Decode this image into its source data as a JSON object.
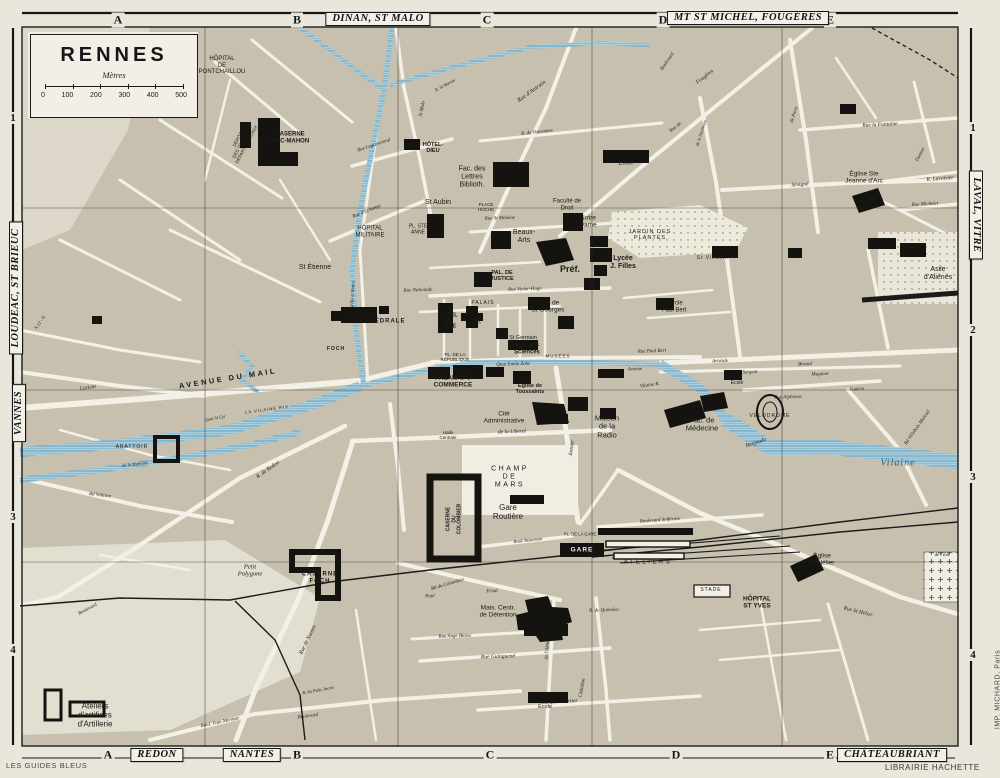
{
  "title_box": {
    "title": "RENNES",
    "unit_label": "Mètres",
    "scale_ticks": [
      "0",
      "100",
      "200",
      "300",
      "400",
      "500"
    ]
  },
  "frame": {
    "top_letters": [
      {
        "t": "A",
        "x": 118
      },
      {
        "t": "B",
        "x": 297
      },
      {
        "t": "C",
        "x": 487
      },
      {
        "t": "D",
        "x": 663
      },
      {
        "t": "E",
        "x": 830
      }
    ],
    "bottom_letters": [
      {
        "t": "A",
        "x": 108
      },
      {
        "t": "B",
        "x": 297
      },
      {
        "t": "C",
        "x": 490
      },
      {
        "t": "D",
        "x": 676
      },
      {
        "t": "E",
        "x": 830
      }
    ],
    "left_numbers": [
      {
        "t": "1",
        "y": 118
      },
      {
        "t": "3",
        "y": 517
      },
      {
        "t": "4",
        "y": 650
      }
    ],
    "right_numbers": [
      {
        "t": "1",
        "y": 128
      },
      {
        "t": "2",
        "y": 330
      },
      {
        "t": "3",
        "y": 477
      },
      {
        "t": "4",
        "y": 655
      }
    ],
    "plates": [
      {
        "t": "DINAN, ST MALO",
        "x": 378,
        "y": 19,
        "r": 0
      },
      {
        "t": "MT ST MICHEL, FOUGÈRES",
        "x": 748,
        "y": 18,
        "r": 0
      },
      {
        "t": "REDON",
        "x": 157,
        "y": 755,
        "r": 0
      },
      {
        "t": "NANTES",
        "x": 252,
        "y": 755,
        "r": 0
      },
      {
        "t": "CHÂTEAUBRIANT",
        "x": 892,
        "y": 755,
        "r": 0
      },
      {
        "t": "LOUDEAC, ST BRIEUC",
        "x": 16,
        "y": 288,
        "r": -90
      },
      {
        "t": "VANNES",
        "x": 19,
        "y": 413,
        "r": -90
      },
      {
        "t": "LAVAL, VITRÉ",
        "x": 976,
        "y": 215,
        "r": 90
      }
    ]
  },
  "credits": {
    "publisher_left": "LES GUIDES BLEUS",
    "publisher_right": "LIBRAIRIE HACHETTE",
    "printer": "IMP. MICHARD, Paris"
  },
  "map_labels": [
    {
      "t": "HÔPITAL\nDE\nPONTCHAILLOU",
      "x": 222,
      "y": 66,
      "s": 6
    },
    {
      "t": "CASERNE\nMAC-MAHON",
      "x": 290,
      "y": 138,
      "s": 6,
      "c": "b"
    },
    {
      "t": "DÉPÔT\nDES TRAMWAYS\nDÉPARTEMENTAUX",
      "x": 242,
      "y": 142,
      "s": 4.5,
      "r": -62
    },
    {
      "t": "HÔTEL-\nDIEU",
      "x": 433,
      "y": 148,
      "s": 5.5,
      "c": "b"
    },
    {
      "t": "Fac. des\nLettres\nBiblioth.",
      "x": 472,
      "y": 177,
      "s": 7
    },
    {
      "t": "St Aubin",
      "x": 438,
      "y": 203,
      "s": 7
    },
    {
      "t": "PL. STE\nANNE",
      "x": 418,
      "y": 230,
      "s": 5
    },
    {
      "t": "PLACE\nHOCHE",
      "x": 486,
      "y": 207,
      "s": 4.5
    },
    {
      "t": "HÔPITAL\nMILITAIRE",
      "x": 370,
      "y": 232,
      "s": 6
    },
    {
      "t": "St Étienne",
      "x": 315,
      "y": 268,
      "s": 7
    },
    {
      "t": "CATHÉDRALE",
      "x": 380,
      "y": 322,
      "s": 6,
      "c": "b sp"
    },
    {
      "t": "HÔTEL\nDE\nVILLE",
      "x": 449,
      "y": 322,
      "s": 5,
      "c": "b"
    },
    {
      "t": "Th.",
      "x": 477,
      "y": 323,
      "s": 6
    },
    {
      "t": "PALAIS",
      "x": 483,
      "y": 304,
      "s": 5,
      "c": "sp"
    },
    {
      "t": "PAL. DE\nJUSTICE",
      "x": 502,
      "y": 276,
      "s": 5.5,
      "c": "b"
    },
    {
      "t": "Beaux-\nArts",
      "x": 524,
      "y": 237,
      "s": 7
    },
    {
      "t": "Faculté de\nDroit",
      "x": 567,
      "y": 205,
      "s": 6
    },
    {
      "t": "Notre\nDame",
      "x": 588,
      "y": 222,
      "s": 6.5
    },
    {
      "t": "École",
      "x": 626,
      "y": 164,
      "s": 6
    },
    {
      "t": "JARDIN DES\nPLANTES",
      "x": 650,
      "y": 235,
      "s": 5.5,
      "c": "sp"
    },
    {
      "t": "Lycée\nJ. Filles",
      "x": 623,
      "y": 263,
      "s": 7,
      "c": "b"
    },
    {
      "t": "Préf.",
      "x": 570,
      "y": 269,
      "s": 9,
      "c": "b"
    },
    {
      "t": "Abb. de\nSt Georges",
      "x": 548,
      "y": 307,
      "s": 6.5
    },
    {
      "t": "St Germain",
      "x": 523,
      "y": 338,
      "s": 5.5
    },
    {
      "t": "Fac. des\nSciences",
      "x": 527,
      "y": 349,
      "s": 6,
      "c": "b"
    },
    {
      "t": "MUSÉES",
      "x": 558,
      "y": 356,
      "s": 4.5,
      "c": "sp"
    },
    {
      "t": "Cercle\nPaul Bert",
      "x": 674,
      "y": 307,
      "s": 6
    },
    {
      "t": "St Vincent",
      "x": 713,
      "y": 259,
      "s": 5,
      "c": "sp"
    },
    {
      "t": "PL. DE LA\nRÉPUBLIQUE",
      "x": 455,
      "y": 357,
      "s": 4.5
    },
    {
      "t": "PALAIS D U\nCOMMERCE",
      "x": 453,
      "y": 382,
      "s": 6.5,
      "c": "b"
    },
    {
      "t": "Église de\nToussaints",
      "x": 530,
      "y": 389,
      "s": 5.5,
      "c": "b"
    },
    {
      "t": "Cité\nAdministrative",
      "x": 504,
      "y": 418,
      "s": 6.5
    },
    {
      "t": "Halle\nCentrale",
      "x": 448,
      "y": 435,
      "s": 4.5
    },
    {
      "t": "Maison\nde la\nRadio",
      "x": 607,
      "y": 427,
      "s": 7.5
    },
    {
      "t": "Fac. de\nMédecine",
      "x": 702,
      "y": 425,
      "s": 7.5
    },
    {
      "t": "VÉLODROME",
      "x": 770,
      "y": 417,
      "s": 5,
      "c": "sp"
    },
    {
      "t": "École",
      "x": 737,
      "y": 384,
      "s": 5
    },
    {
      "t": "ABATTOIR",
      "x": 132,
      "y": 448,
      "s": 5,
      "c": "sp"
    },
    {
      "t": "CHAMP\nDE\nMARS",
      "x": 510,
      "y": 477,
      "s": 7,
      "c": "sp2"
    },
    {
      "t": "Gare\nRoutière",
      "x": 508,
      "y": 513,
      "s": 8
    },
    {
      "t": "CASERNE\nDU\nCOLOMBIER",
      "x": 455,
      "y": 519,
      "s": 5,
      "r": -90,
      "c": "b"
    },
    {
      "t": "PL. DE LA GARE",
      "x": 580,
      "y": 535,
      "s": 4.2
    },
    {
      "t": "GARE",
      "x": 582,
      "y": 550,
      "s": 6.5,
      "c": "b w sp"
    },
    {
      "t": "ATELIERS",
      "x": 648,
      "y": 563,
      "s": 6,
      "c": "sp2"
    },
    {
      "t": "STADE",
      "x": 711,
      "y": 591,
      "s": 5,
      "c": "sp"
    },
    {
      "t": "HÔPITAL\nST YVES",
      "x": 757,
      "y": 603,
      "s": 6.5,
      "c": "b"
    },
    {
      "t": "Église\nSt Hélier",
      "x": 822,
      "y": 560,
      "s": 6.5
    },
    {
      "t": "Petit\nPolygone",
      "x": 250,
      "y": 571,
      "s": 6.5,
      "c": "i"
    },
    {
      "t": "CASERNE\nFOCH",
      "x": 320,
      "y": 578,
      "s": 6,
      "c": "b sp"
    },
    {
      "t": "Mais. Centr.\nde Détention",
      "x": 498,
      "y": 612,
      "s": 6.5
    },
    {
      "t": "École",
      "x": 545,
      "y": 707,
      "s": 5.5
    },
    {
      "t": "Ateliers\nd'artifices\nd'Artillerie",
      "x": 95,
      "y": 716,
      "s": 8
    },
    {
      "t": "Asile\nd'Aliénés",
      "x": 938,
      "y": 274,
      "s": 7
    },
    {
      "t": "Église Ste\nJeanne d'Arc",
      "x": 864,
      "y": 178,
      "s": 6.5
    },
    {
      "t": "de l'Est",
      "x": 942,
      "y": 556,
      "s": 5,
      "c": "i"
    },
    {
      "t": "Vilaine",
      "x": 898,
      "y": 463,
      "s": 10,
      "c": "i blue sp"
    },
    {
      "t": "Vilaine R.",
      "x": 650,
      "y": 386,
      "s": 5,
      "r": -8,
      "c": "i"
    },
    {
      "t": "Baignade",
      "x": 756,
      "y": 443,
      "s": 5.5,
      "r": -18,
      "c": "i"
    },
    {
      "t": "LA VILAINE RIV.",
      "x": 268,
      "y": 410,
      "s": 4.2,
      "r": -8,
      "c": "sp"
    },
    {
      "t": "AVENUE DU MAIL",
      "x": 228,
      "y": 379,
      "s": 7.5,
      "r": -9,
      "c": "b sp2"
    },
    {
      "t": "Quai Emile Zola",
      "x": 513,
      "y": 365,
      "s": 5,
      "r": -2,
      "c": "i"
    },
    {
      "t": "Rue Nationale",
      "x": 418,
      "y": 291,
      "s": 5,
      "r": -2,
      "c": "i"
    },
    {
      "t": "Rue Victor-Hugo",
      "x": 525,
      "y": 290,
      "s": 5,
      "r": -2,
      "c": "i"
    },
    {
      "t": "Rue St Melaine",
      "x": 500,
      "y": 219,
      "s": 5,
      "r": -2,
      "c": "i"
    },
    {
      "t": "Rue d'Antrain",
      "x": 532,
      "y": 92,
      "s": 6,
      "r": -36,
      "c": "i"
    },
    {
      "t": "R. de Vincennes",
      "x": 537,
      "y": 133,
      "s": 5,
      "r": -6,
      "c": "i"
    },
    {
      "t": "Rue de",
      "x": 676,
      "y": 128,
      "s": 5,
      "r": -38,
      "c": "i"
    },
    {
      "t": "Fougères",
      "x": 705,
      "y": 77,
      "s": 5.5,
      "r": -38,
      "c": "i"
    },
    {
      "t": "Boulevard",
      "x": 668,
      "y": 62,
      "s": 5,
      "r": -55,
      "c": "i"
    },
    {
      "t": "de la Duchesse",
      "x": 701,
      "y": 133,
      "s": 4.5,
      "r": -72,
      "c": "i"
    },
    {
      "t": "R. St Martin",
      "x": 445,
      "y": 85,
      "s": 4.5,
      "r": -28,
      "c": "i"
    },
    {
      "t": "St Malo",
      "x": 423,
      "y": 109,
      "s": 5,
      "r": -78,
      "c": "i"
    },
    {
      "t": "Rue Legraverend",
      "x": 374,
      "y": 146,
      "s": 5,
      "r": -18,
      "c": "i"
    },
    {
      "t": "Rue d'Echange",
      "x": 367,
      "y": 212,
      "s": 5,
      "r": -22,
      "c": "i"
    },
    {
      "t": "Canal d'Ille et Rance",
      "x": 352,
      "y": 300,
      "s": 4.5,
      "r": -87,
      "c": "i"
    },
    {
      "t": "Rue la Fontaine",
      "x": 880,
      "y": 125,
      "s": 5.5,
      "r": -3,
      "c": "i"
    },
    {
      "t": "Sévigné",
      "x": 800,
      "y": 185,
      "s": 5.5,
      "r": -4,
      "c": "i"
    },
    {
      "t": "Danton",
      "x": 921,
      "y": 155,
      "s": 5,
      "r": -62,
      "c": "i"
    },
    {
      "t": "de Paris",
      "x": 795,
      "y": 115,
      "s": 5,
      "r": -72,
      "c": "i"
    },
    {
      "t": "R. Lavoisier",
      "x": 940,
      "y": 179,
      "s": 5.5,
      "r": -4,
      "c": "i"
    },
    {
      "t": "Rue Michelet",
      "x": 925,
      "y": 205,
      "s": 5,
      "r": -3,
      "c": "i"
    },
    {
      "t": "Avenue",
      "x": 635,
      "y": 370,
      "s": 5,
      "r": -2,
      "c": "i"
    },
    {
      "t": "Aristide",
      "x": 720,
      "y": 362,
      "s": 5,
      "r": -2,
      "c": "i"
    },
    {
      "t": "Briand",
      "x": 805,
      "y": 365,
      "s": 5,
      "r": -2,
      "c": "i"
    },
    {
      "t": "Sergent",
      "x": 750,
      "y": 373,
      "s": 5,
      "r": -2,
      "c": "i"
    },
    {
      "t": "Maginot",
      "x": 820,
      "y": 375,
      "s": 5,
      "r": -2,
      "c": "i"
    },
    {
      "t": "Rue Paul Bert",
      "x": 652,
      "y": 352,
      "s": 5,
      "r": -2,
      "c": "i"
    },
    {
      "t": "Rue Alphonse",
      "x": 788,
      "y": 398,
      "s": 5,
      "r": -2,
      "c": "i"
    },
    {
      "t": "Guérin",
      "x": 857,
      "y": 390,
      "s": 5,
      "r": -2,
      "c": "i"
    },
    {
      "t": "Bd Villebois Mareuil",
      "x": 918,
      "y": 428,
      "s": 5,
      "r": -55,
      "c": "i"
    },
    {
      "t": "Janvier",
      "x": 572,
      "y": 448,
      "s": 5.5,
      "r": -82,
      "c": "i"
    },
    {
      "t": "de la Liberté",
      "x": 512,
      "y": 432,
      "s": 5.5,
      "r": -2,
      "c": "i"
    },
    {
      "t": "Boul. Beaumont",
      "x": 528,
      "y": 540,
      "s": 4.5,
      "r": -6,
      "c": "i"
    },
    {
      "t": "Boulevard Solférino",
      "x": 660,
      "y": 521,
      "s": 5,
      "r": -4,
      "c": "i"
    },
    {
      "t": "Rue St Hélier",
      "x": 858,
      "y": 612,
      "s": 5.5,
      "r": 14,
      "c": "i"
    },
    {
      "t": "Bd du Colombier",
      "x": 448,
      "y": 585,
      "s": 5,
      "r": -16,
      "c": "i"
    },
    {
      "t": "Rue de Nantes",
      "x": 308,
      "y": 640,
      "s": 5.5,
      "r": -64,
      "c": "i"
    },
    {
      "t": "R. de Redon",
      "x": 268,
      "y": 470,
      "s": 5.5,
      "r": -35,
      "c": "i"
    },
    {
      "t": "Lorient",
      "x": 88,
      "y": 388,
      "s": 5.5,
      "r": -8,
      "c": "i"
    },
    {
      "t": "Quai St Cyr",
      "x": 215,
      "y": 418,
      "s": 4.5,
      "r": -10,
      "c": "i"
    },
    {
      "t": "de la Mabilais",
      "x": 135,
      "y": 464,
      "s": 4.5,
      "r": -6,
      "c": "i"
    },
    {
      "t": "Bd Voltaire",
      "x": 100,
      "y": 496,
      "s": 5,
      "r": 7,
      "c": "i"
    },
    {
      "t": "Boulevard",
      "x": 88,
      "y": 610,
      "s": 5,
      "r": -28,
      "c": "i"
    },
    {
      "t": "Boul. Jean Mermoz",
      "x": 220,
      "y": 723,
      "s": 5,
      "r": -12,
      "c": "i"
    },
    {
      "t": "Boulevard",
      "x": 308,
      "y": 717,
      "s": 5,
      "r": -8,
      "c": "i"
    },
    {
      "t": "R. du Puits Jacob",
      "x": 318,
      "y": 690,
      "s": 4.5,
      "r": -10,
      "c": "i"
    },
    {
      "t": "Jacques Cartier",
      "x": 560,
      "y": 702,
      "s": 5.5,
      "r": -3,
      "c": "i"
    },
    {
      "t": "Rue Guinguené",
      "x": 498,
      "y": 657,
      "s": 5.5,
      "r": -2,
      "c": "i"
    },
    {
      "t": "Rue Ange Blaise",
      "x": 455,
      "y": 637,
      "s": 5,
      "r": -2,
      "c": "i"
    },
    {
      "t": "Paul",
      "x": 430,
      "y": 597,
      "s": 5,
      "r": -2,
      "c": "i"
    },
    {
      "t": "Féval",
      "x": 492,
      "y": 592,
      "s": 5,
      "r": -2,
      "c": "i"
    },
    {
      "t": "R. de Quineleu",
      "x": 604,
      "y": 611,
      "s": 5,
      "r": -2,
      "c": "i"
    },
    {
      "t": "Châtillon",
      "x": 583,
      "y": 688,
      "s": 5,
      "r": -80,
      "c": "i"
    },
    {
      "t": "de l'Alma",
      "x": 548,
      "y": 650,
      "s": 5,
      "r": -85,
      "c": "i"
    },
    {
      "t": "N.12 - N.",
      "x": 40,
      "y": 322,
      "s": 4.5,
      "r": -55,
      "c": "i"
    },
    {
      "t": "FOCH",
      "x": 336,
      "y": 350,
      "s": 5,
      "c": "b sp"
    }
  ]
}
